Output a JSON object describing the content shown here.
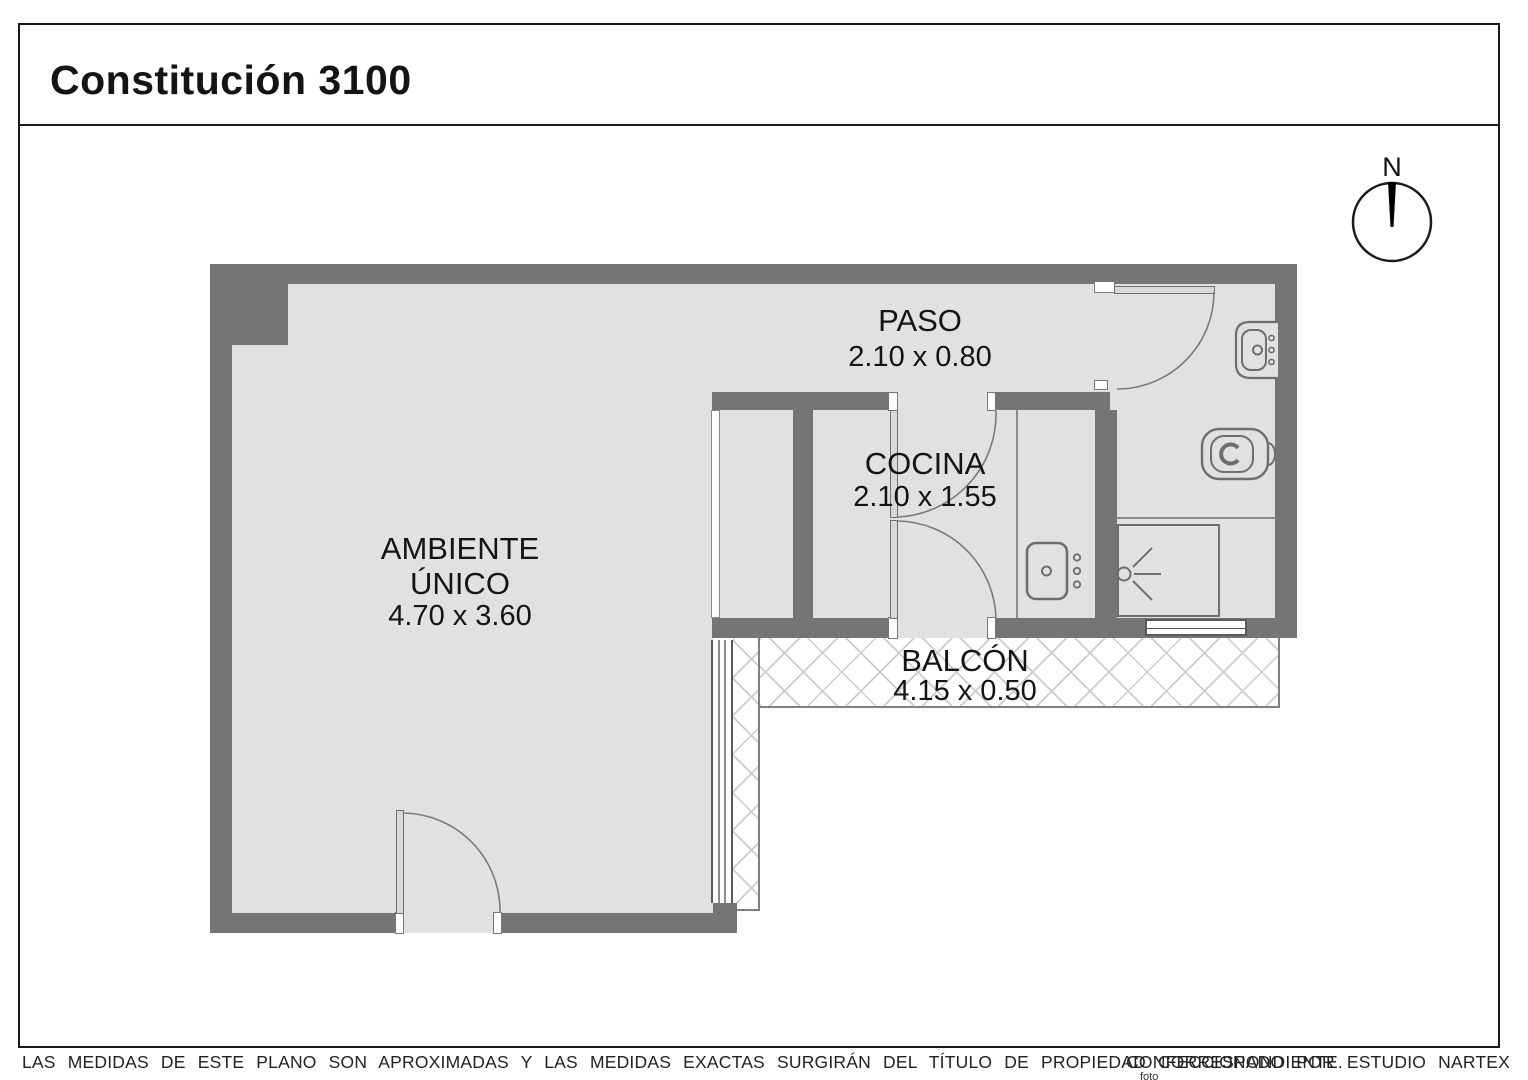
{
  "header": {
    "title": "Constitución 3100"
  },
  "compass": {
    "north_label": "N"
  },
  "rooms": {
    "paso": {
      "name": "PASO",
      "dimensions": "2.10 x 0.80"
    },
    "cocina": {
      "name": "COCINA",
      "dimensions": "2.10 x 1.55"
    },
    "ambiente": {
      "name_line1": "AMBIENTE",
      "name_line2": "ÚNICO",
      "dimensions": "4.70 x 3.60"
    },
    "balcon": {
      "name": "BALCÓN",
      "dimensions": "4.15 x 0.50"
    }
  },
  "fixtures": {
    "bathroom_sink": "sink-icon",
    "toilet": "toilet-icon",
    "kitchen_sink": "kitchen-sink-icon",
    "shower": "shower-icon",
    "compass": "north-compass-icon"
  },
  "footer": {
    "disclaimer": "LAS MEDIDAS DE ESTE PLANO SON APROXIMADAS Y LAS MEDIDAS EXACTAS SURGIRÁN DEL TÍTULO DE PROPIEDAD CORRESPONDIENTE.",
    "credit": "CONFECCIONADO POR ESTUDIO NARTEX",
    "note": "foto"
  },
  "colors": {
    "wall": "#757575",
    "floor": "#e1e1e1",
    "hatch_line": "#cccccc",
    "outline": "#6e6e6e",
    "frame": "#1a1a1a",
    "text": "#1c1c1c"
  }
}
